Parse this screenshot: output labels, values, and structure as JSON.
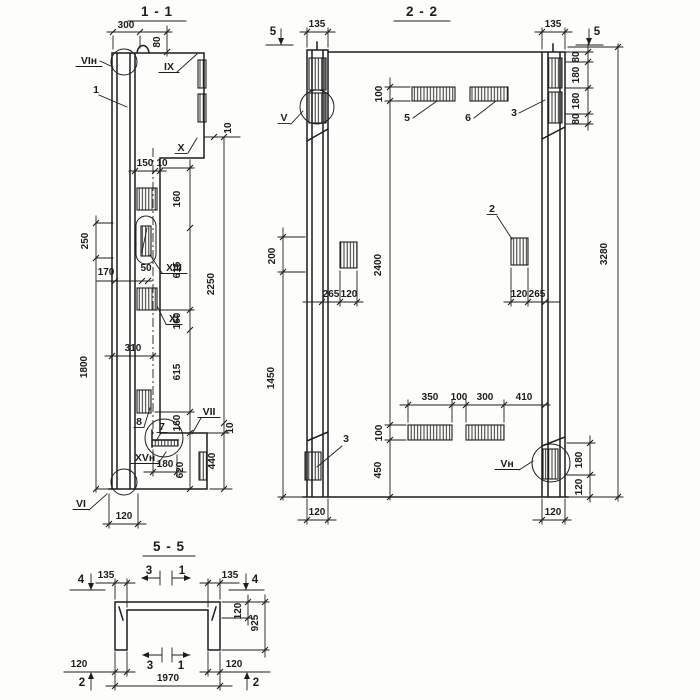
{
  "palette": {
    "ink": "#1d1d1d",
    "paper": "#fdfdfb"
  },
  "titles": [
    {
      "t": "1 - 1",
      "x": 157,
      "y": 16
    },
    {
      "t": "2 - 2",
      "x": 422,
      "y": 16
    },
    {
      "t": "5 - 5",
      "x": 169,
      "y": 551
    }
  ],
  "dims": [
    {
      "t": "300",
      "x": 126,
      "y": 28
    },
    {
      "t": "80",
      "x": 160,
      "y": 42,
      "r": 1
    },
    {
      "t": "10",
      "x": 231,
      "y": 128,
      "r": 1
    },
    {
      "t": "150",
      "x": 145,
      "y": 166
    },
    {
      "t": "10",
      "x": 162,
      "y": 166
    },
    {
      "t": "160",
      "x": 180,
      "y": 199,
      "r": 1
    },
    {
      "t": "615",
      "x": 180,
      "y": 270,
      "r": 1
    },
    {
      "t": "160",
      "x": 180,
      "y": 321,
      "r": 1
    },
    {
      "t": "615",
      "x": 180,
      "y": 372,
      "r": 1
    },
    {
      "t": "160",
      "x": 180,
      "y": 423,
      "r": 1
    },
    {
      "t": "2250",
      "x": 214,
      "y": 284,
      "r": 1
    },
    {
      "t": "250",
      "x": 88,
      "y": 241,
      "r": 1
    },
    {
      "t": "170",
      "x": 106,
      "y": 275
    },
    {
      "t": "50",
      "x": 146,
      "y": 271
    },
    {
      "t": "310",
      "x": 133,
      "y": 351
    },
    {
      "t": "1800",
      "x": 87,
      "y": 367,
      "r": 1
    },
    {
      "t": "10",
      "x": 233,
      "y": 428,
      "r": 1
    },
    {
      "t": "440",
      "x": 215,
      "y": 461,
      "r": 1
    },
    {
      "t": "180",
      "x": 165,
      "y": 467
    },
    {
      "t": "620",
      "x": 183,
      "y": 470,
      "r": 1
    },
    {
      "t": "120",
      "x": 124,
      "y": 519
    },
    {
      "t": "135",
      "x": 317,
      "y": 27
    },
    {
      "t": "135",
      "x": 553,
      "y": 27
    },
    {
      "t": "100",
      "x": 382,
      "y": 94,
      "r": 1
    },
    {
      "t": "80",
      "x": 579,
      "y": 57,
      "r": 1
    },
    {
      "t": "180",
      "x": 579,
      "y": 75,
      "r": 1
    },
    {
      "t": "180",
      "x": 579,
      "y": 101,
      "r": 1
    },
    {
      "t": "80",
      "x": 579,
      "y": 119,
      "r": 1
    },
    {
      "t": "3280",
      "x": 607,
      "y": 254,
      "r": 1
    },
    {
      "t": "200",
      "x": 275,
      "y": 256,
      "r": 1
    },
    {
      "t": "1450",
      "x": 274,
      "y": 378,
      "r": 1
    },
    {
      "t": "2400",
      "x": 381,
      "y": 265,
      "r": 1
    },
    {
      "t": "265",
      "x": 331,
      "y": 297
    },
    {
      "t": "120",
      "x": 349,
      "y": 297
    },
    {
      "t": "120",
      "x": 519,
      "y": 297
    },
    {
      "t": "265",
      "x": 537,
      "y": 297
    },
    {
      "t": "350",
      "x": 430,
      "y": 400
    },
    {
      "t": "100",
      "x": 459,
      "y": 400
    },
    {
      "t": "300",
      "x": 485,
      "y": 400
    },
    {
      "t": "410",
      "x": 524,
      "y": 400
    },
    {
      "t": "100",
      "x": 382,
      "y": 433,
      "r": 1
    },
    {
      "t": "450",
      "x": 381,
      "y": 470,
      "r": 1
    },
    {
      "t": "180",
      "x": 582,
      "y": 460,
      "r": 1
    },
    {
      "t": "120",
      "x": 582,
      "y": 487,
      "r": 1
    },
    {
      "t": "120",
      "x": 317,
      "y": 515
    },
    {
      "t": "120",
      "x": 553,
      "y": 515
    },
    {
      "t": "135",
      "x": 106,
      "y": 578
    },
    {
      "t": "135",
      "x": 230,
      "y": 578
    },
    {
      "t": "120",
      "x": 241,
      "y": 611,
      "r": 1
    },
    {
      "t": "925",
      "x": 258,
      "y": 623,
      "r": 1
    },
    {
      "t": "120",
      "x": 79,
      "y": 667
    },
    {
      "t": "120",
      "x": 234,
      "y": 667
    },
    {
      "t": "1970",
      "x": 168,
      "y": 681
    }
  ],
  "labels": [
    {
      "t": "VIн",
      "x": 89,
      "y": 64,
      "u": 13
    },
    {
      "t": "1",
      "x": 96,
      "y": 93,
      "u": 0
    },
    {
      "t": "IX",
      "x": 169,
      "y": 70,
      "u": 10
    },
    {
      "t": "X",
      "x": 181,
      "y": 151,
      "u": 6
    },
    {
      "t": "XIII",
      "x": 174,
      "y": 271,
      "u": 13
    },
    {
      "t": "XI",
      "x": 174,
      "y": 322,
      "u": 8
    },
    {
      "t": "8",
      "x": 139,
      "y": 425,
      "u": 5
    },
    {
      "t": "7",
      "x": 162,
      "y": 430,
      "u": 5
    },
    {
      "t": "XVн",
      "x": 145,
      "y": 461,
      "u": 14
    },
    {
      "t": "VII",
      "x": 209,
      "y": 415,
      "u": 11
    },
    {
      "t": "VI",
      "x": 81,
      "y": 507,
      "u": 8
    },
    {
      "t": "V",
      "x": 284,
      "y": 121,
      "u": 6
    },
    {
      "t": "3",
      "x": 514,
      "y": 116,
      "u": 0
    },
    {
      "t": "5",
      "x": 407,
      "y": 121,
      "u": 0
    },
    {
      "t": "6",
      "x": 468,
      "y": 121,
      "u": 0
    },
    {
      "t": "2",
      "x": 492,
      "y": 212,
      "u": 5
    },
    {
      "t": "3",
      "x": 346,
      "y": 442,
      "u": 0
    },
    {
      "t": "Vн",
      "x": 507,
      "y": 467,
      "u": 12
    }
  ],
  "markers": [
    {
      "t": "5",
      "x": 273,
      "y": 35
    },
    {
      "t": "5",
      "x": 597,
      "y": 35
    },
    {
      "t": "4",
      "x": 81,
      "y": 583
    },
    {
      "t": "4",
      "x": 255,
      "y": 583
    },
    {
      "t": "3",
      "x": 149,
      "y": 574
    },
    {
      "t": "1",
      "x": 182,
      "y": 574
    },
    {
      "t": "3",
      "x": 150,
      "y": 669
    },
    {
      "t": "1",
      "x": 181,
      "y": 669
    },
    {
      "t": "2",
      "x": 82,
      "y": 686
    },
    {
      "t": "2",
      "x": 256,
      "y": 686
    }
  ]
}
